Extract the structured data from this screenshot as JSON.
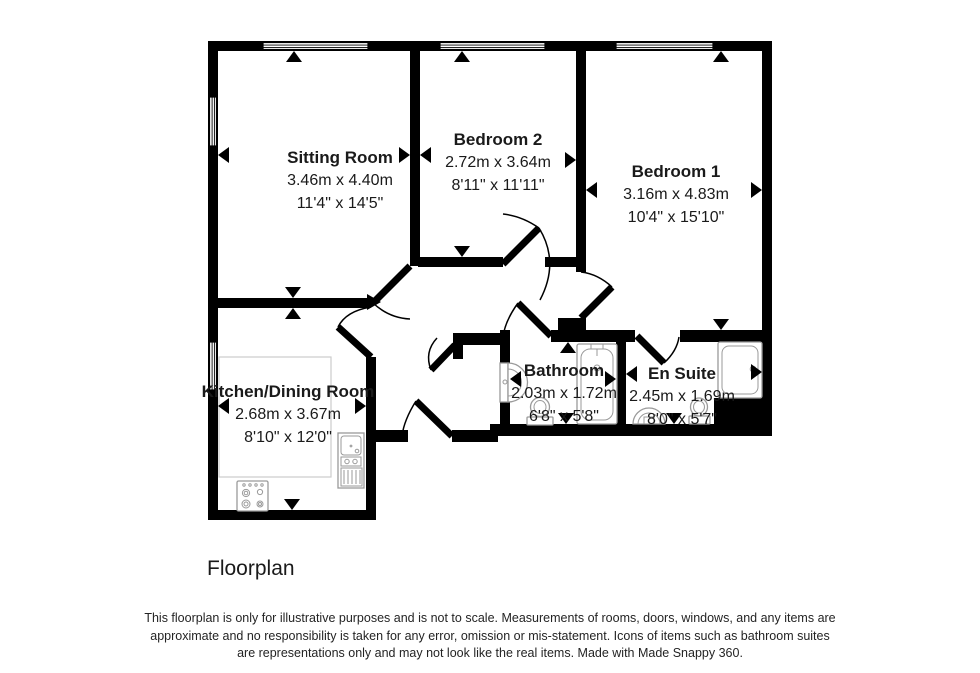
{
  "floorplan": {
    "title": "Floorplan",
    "rooms": [
      {
        "id": "sitting-room",
        "name": "Sitting Room",
        "size_m": "3.46m x 4.40m",
        "size_ft": "11'4\" x 14'5\""
      },
      {
        "id": "bedroom-2",
        "name": "Bedroom 2",
        "size_m": "2.72m x 3.64m",
        "size_ft": "8'11\" x 11'11\""
      },
      {
        "id": "bedroom-1",
        "name": "Bedroom 1",
        "size_m": "3.16m x 4.83m",
        "size_ft": "10'4\" x 15'10\""
      },
      {
        "id": "kitchen-dining-room",
        "name": "Kitchen/Dining Room",
        "size_m": "2.68m x 3.67m",
        "size_ft": "8'10\" x 12'0\""
      },
      {
        "id": "bathroom",
        "name": "Bathroom",
        "size_m": "2.03m x 1.72m",
        "size_ft": "6'8\" x 5'8\""
      },
      {
        "id": "en-suite",
        "name": "En Suite",
        "size_m": "2.45m x 1.69m",
        "size_ft": "8'0\" x 5'7\""
      }
    ],
    "disclaimer": [
      "This floorplan is only for illustrative purposes and is not to scale. Measurements of rooms, doors, windows, and any items are",
      "approximate and no responsibility is taken for any error, omission or mis-statement. Icons of items such as bathroom suites",
      "are representations only and may not look like the real items. Made with Made Snappy 360."
    ],
    "icons": [
      "window-icon",
      "door-swing-icon",
      "bathtub-icon",
      "shower-icon",
      "toilet-icon",
      "wash-basin-icon",
      "kitchen-sink-icon",
      "hob-icon",
      "dimension-arrow-icon"
    ],
    "colors": {
      "wall": "#000000",
      "fixture_outline": "#9a9a9a",
      "text": "#1a1a1a",
      "background": "#ffffff"
    }
  }
}
